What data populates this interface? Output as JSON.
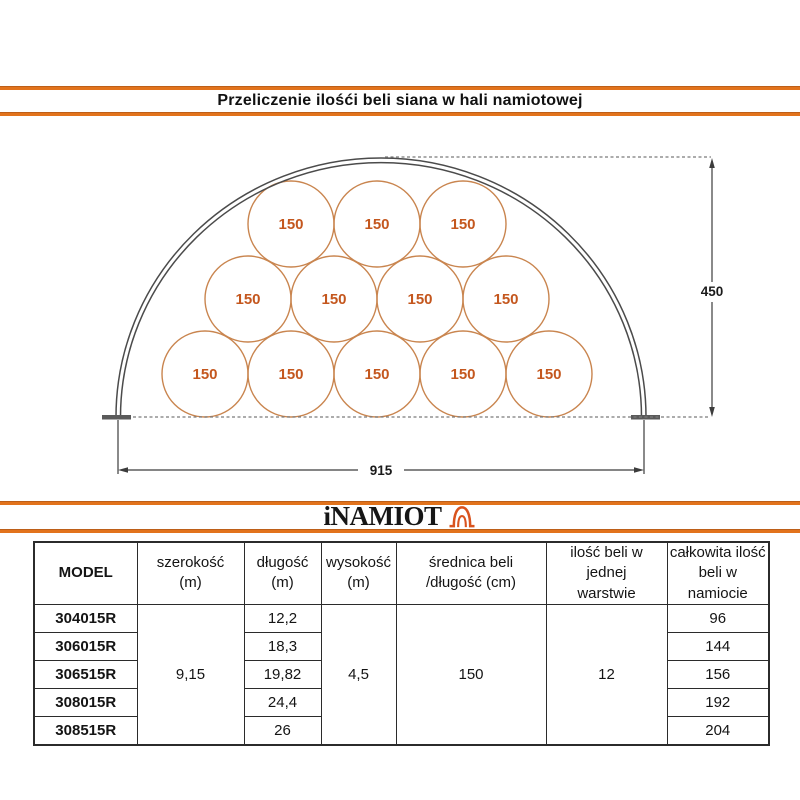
{
  "title": "Przeliczenie ilośći beli siana w hali namiotowej",
  "brand": {
    "logo_text": "iNAMIOT",
    "accent_color": "#e2731c"
  },
  "diagram": {
    "bale_label": "150",
    "bale_count": 12,
    "rows_layout": [
      5,
      4,
      3
    ],
    "height_dim": "450",
    "width_dim": "915",
    "bale_stroke_color": "#c9854f",
    "bale_text_color": "#c4571e",
    "arch_color": "#4b4b4b"
  },
  "table": {
    "headers": [
      {
        "line1": "MODEL",
        "line2": ""
      },
      {
        "line1": "szerokość",
        "line2": "(m)"
      },
      {
        "line1": "długość",
        "line2": "(m)"
      },
      {
        "line1": "wysokość",
        "line2": "(m)"
      },
      {
        "line1": "średnica beli",
        "line2": "/długość (cm)"
      },
      {
        "line1": "ilość beli w jednej",
        "line2": "warstwie"
      },
      {
        "line1": "całkowita ilość",
        "line2": "beli w namiocie"
      }
    ],
    "shared": {
      "szerokosc": "9,15",
      "wysokosc": "4,5",
      "srednica": "150",
      "ilosc_warstwa": "12"
    },
    "rows": [
      {
        "model": "304015R",
        "dlugosc": "12,2",
        "total": "96"
      },
      {
        "model": "306015R",
        "dlugosc": "18,3",
        "total": "144"
      },
      {
        "model": "306515R",
        "dlugosc": "19,82",
        "total": "156"
      },
      {
        "model": "308015R",
        "dlugosc": "24,4",
        "total": "192"
      },
      {
        "model": "308515R",
        "dlugosc": "26",
        "total": "204"
      }
    ]
  }
}
